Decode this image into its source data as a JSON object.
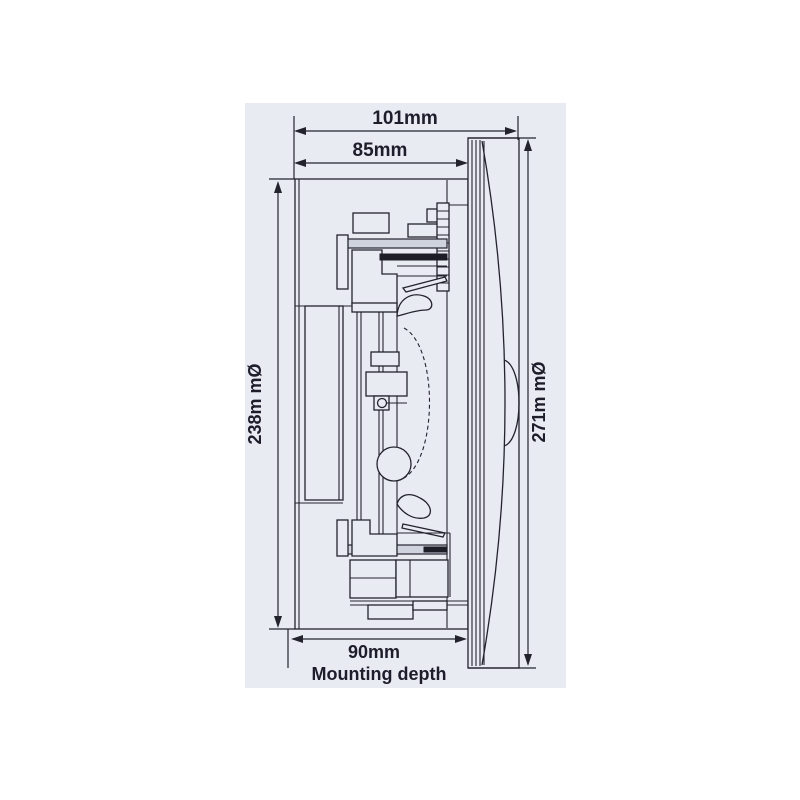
{
  "diagram": {
    "name": "ceiling-speaker-side-view-dimension-drawing",
    "colors": {
      "page_background": "#ffffff",
      "panel_background": "#e9ebf3",
      "line": "#23232e",
      "text": "#1d1d2b"
    },
    "labels": {
      "overall_depth": "101mm",
      "body_depth": "85mm",
      "cutout_diameter": "238m mØ",
      "overall_diameter": "271m mØ",
      "mounting_depth_value": "90mm",
      "mounting_depth_caption": "Mounting depth"
    }
  }
}
